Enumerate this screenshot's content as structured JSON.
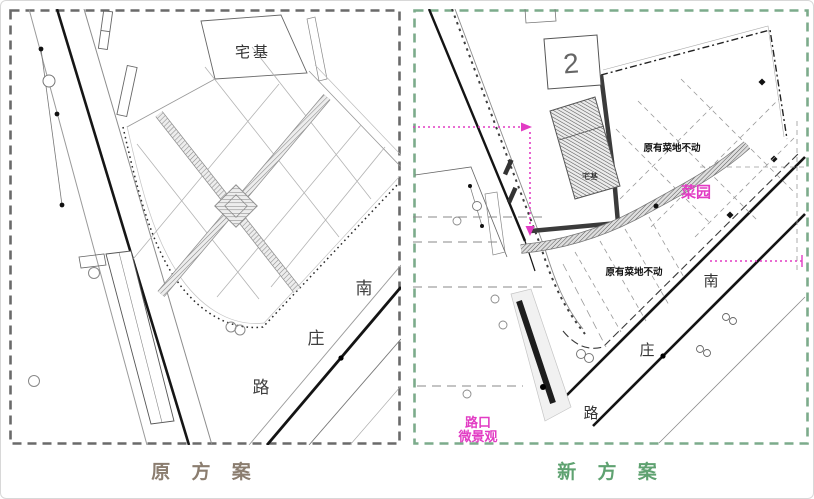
{
  "panels": {
    "original": {
      "caption": "原 方 案",
      "caption_color": "#8b7d6f",
      "border_color": "#6a6a6a",
      "labels": {
        "homestead": "宅基",
        "road_char_1": "南",
        "road_char_2": "庄",
        "road_char_3": "路"
      }
    },
    "new": {
      "caption": "新 方 案",
      "caption_color": "#5fa271",
      "border_color": "#7cab8b",
      "accent_magenta": "#e23cc4",
      "labels": {
        "plot_number": "2",
        "homestead": "宅基",
        "field_note_upper": "原有菜地不动",
        "field_note_lower": "原有菜地不动",
        "garden": "菜园",
        "intersection_note_line1": "路口",
        "intersection_note_line2": "微景观",
        "road_char_1": "南",
        "road_char_2": "庄",
        "road_char_3": "路"
      }
    }
  }
}
